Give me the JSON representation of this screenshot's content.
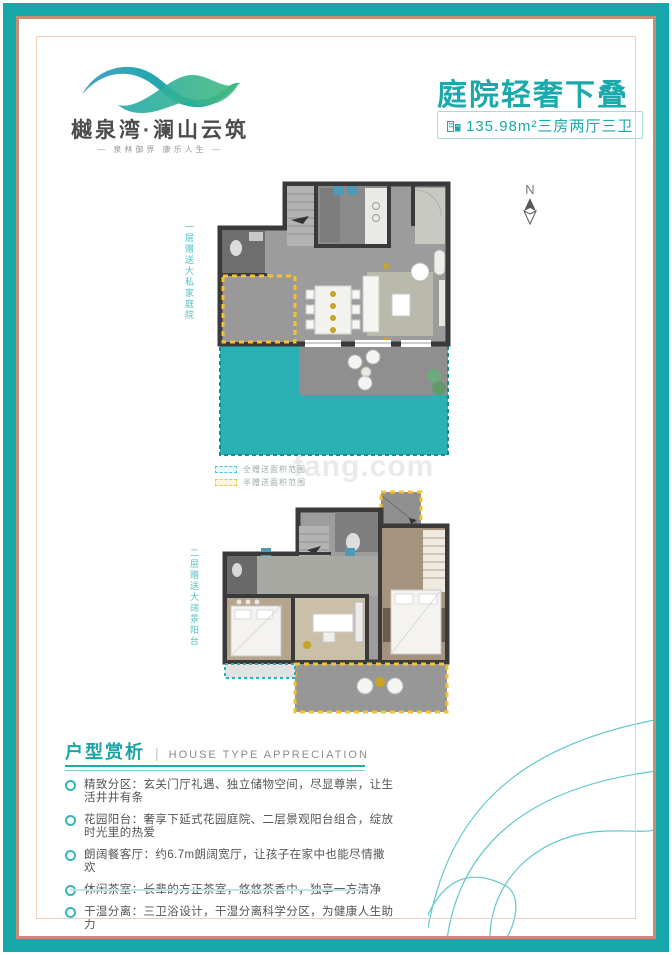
{
  "logo": {
    "name": "樾泉湾·澜山云筑",
    "tagline": "— 泉林御界  康乐人生 —"
  },
  "header": {
    "title": "庭院轻奢下叠",
    "spec": "135.98m²三房两厅三卫"
  },
  "compass": {
    "label": "N"
  },
  "plans": {
    "first_floor_note": "一层赠送大私家庭院",
    "second_floor_note": "二层赠送大阔景阳台",
    "legend": [
      {
        "label": "全赠送面积范围",
        "swatch_color": "#4fc3c7"
      },
      {
        "label": "半赠送面积范围",
        "swatch_color": "#f0c24a"
      }
    ]
  },
  "watermark": {
    "text": "fang.com"
  },
  "section": {
    "title_zh": "户型赏析",
    "separator": "|",
    "title_en": "HOUSE TYPE APPRECIATION"
  },
  "features": [
    "精致分区：玄关门厅礼遇、独立储物空间，尽显尊崇，让生活井井有条",
    "花园阳台：奢享下延式花园庭院、二层景观阳台组合，绽放时光里的热爱",
    "朗阔餐客厅：约6.7m朗阔宽厅，让孩子在家中也能尽情撒欢",
    "休闲茶室：长辈的方正茶室，悠悠茶香中，独享一方清净",
    "干湿分离：三卫浴设计，干湿分离科学分区，为健康人生助力"
  ],
  "colors": {
    "brand_teal": "#17a8ab",
    "courtyard_teal": "#2ab1b4",
    "gift_yellow": "#f3c32f",
    "frame_tan": "#c78e72",
    "wall_dark": "#3a3a3a"
  }
}
